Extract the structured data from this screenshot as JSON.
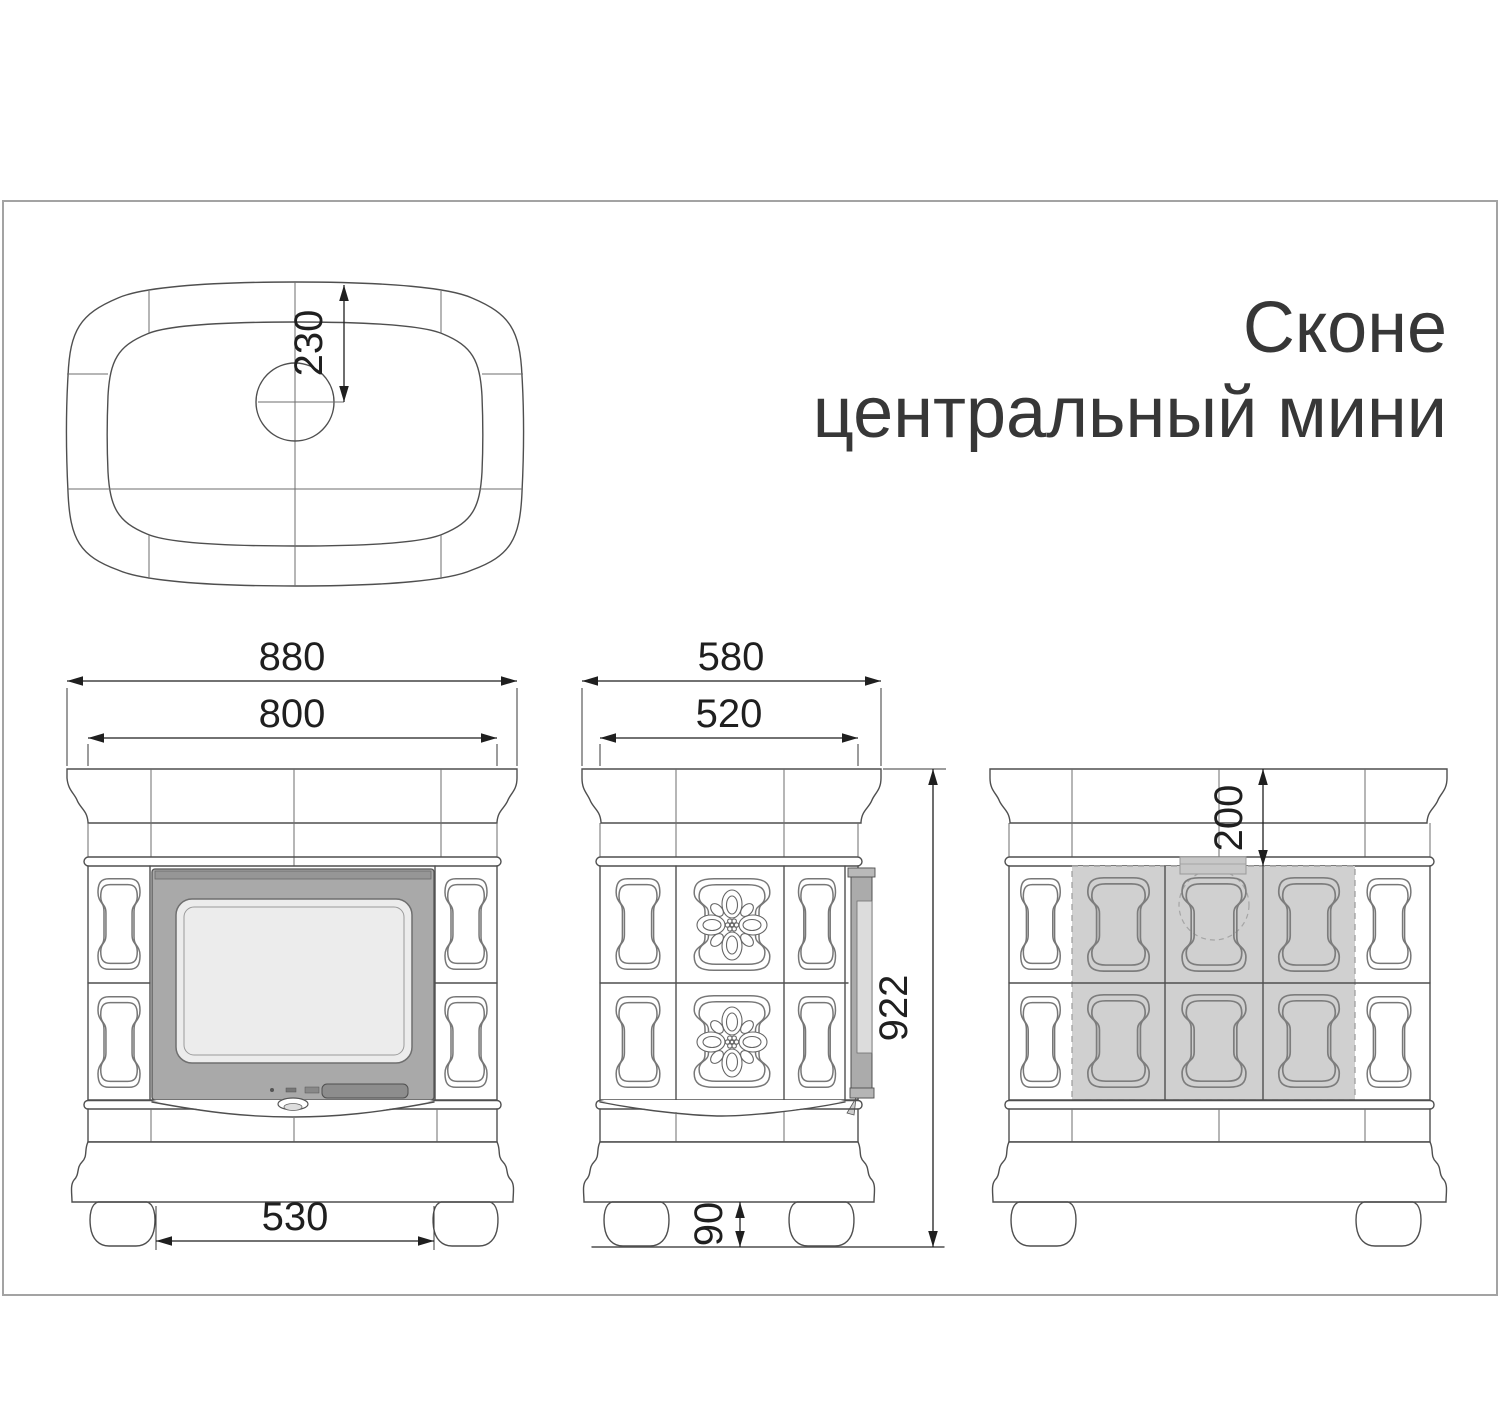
{
  "title": {
    "line1": "Сконе",
    "line2": "центральный мини"
  },
  "views": {
    "top": {
      "name": "top view",
      "chimney_offset": "230"
    },
    "front": {
      "name": "front view",
      "overall_width": "880",
      "top_width": "800",
      "feet_span": "530"
    },
    "side": {
      "name": "side view",
      "overall_depth": "580",
      "top_depth": "520",
      "overall_height": "922",
      "foot_height": "90"
    },
    "rear": {
      "name": "rear view",
      "flue_offset": "200"
    }
  },
  "colors": {
    "line": "#4f4f4f",
    "dimension": "#1f1f1f",
    "door_frame": "#a9a9a9",
    "door_glass": "#ececec",
    "door_handle": "#8d8d8d",
    "shaded_area": "#d0d0d0",
    "flue_stub": "#c7c7c7",
    "frame_border": "#a3a3a3",
    "title_text": "#373737"
  }
}
